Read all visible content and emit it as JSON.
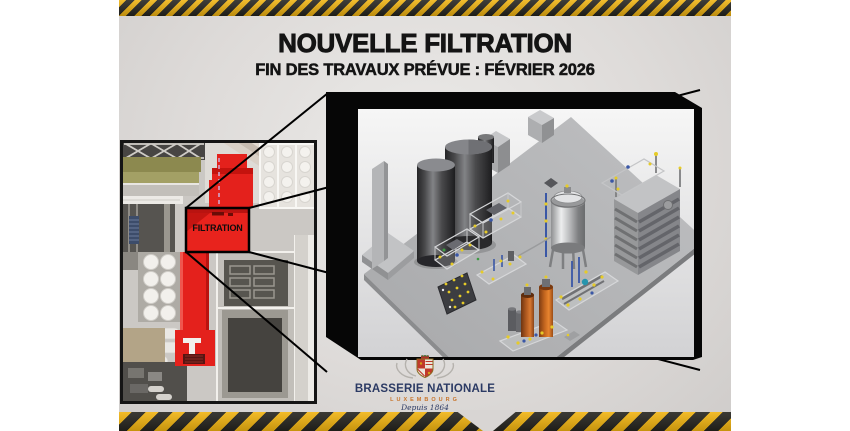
{
  "poster": {
    "title": "NOUVELLE FILTRATION",
    "subtitle": "FIN DES TRAVAUX PRÉVUE : FÉVRIER 2026",
    "filtration_label": "FILTRATION",
    "logo": {
      "brand": "BRASSERIE NATIONALE",
      "city": "LUXEMBOURG",
      "since": "Depuis 1864"
    },
    "colors": {
      "hazard_yellow": "#F1B411",
      "hazard_black": "#25241E",
      "highlight_red": "#E8231D",
      "background_grey": "#DDDAD8",
      "frame_black": "#060606",
      "logo_navy": "#2B3A64",
      "logo_orange": "#C8742A"
    }
  }
}
